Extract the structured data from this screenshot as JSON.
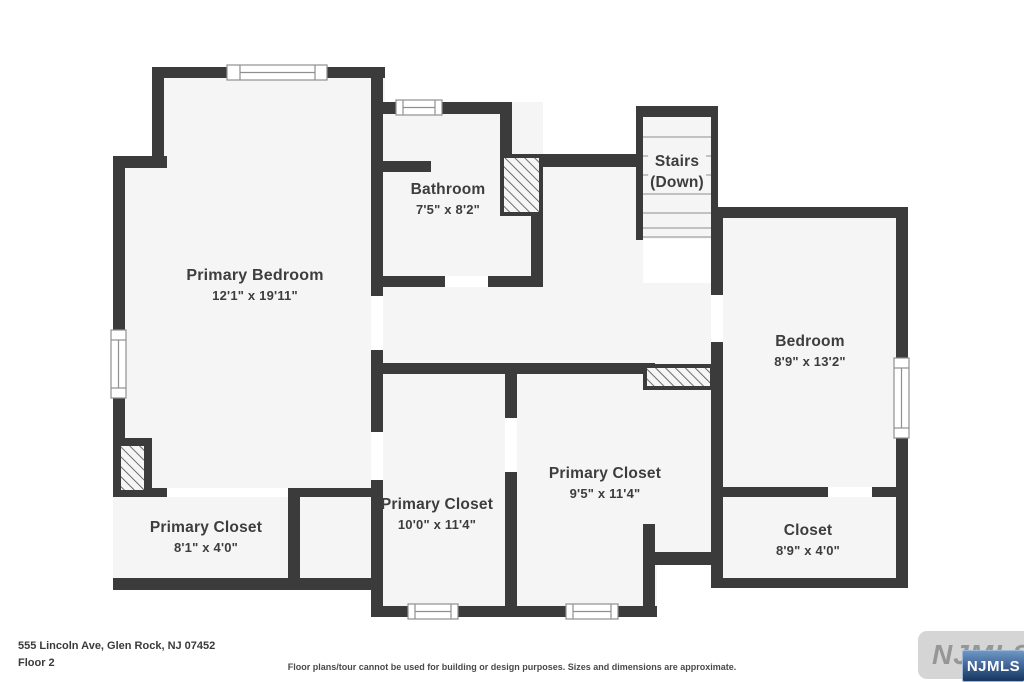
{
  "rooms": {
    "primary_bedroom": {
      "name": "Primary Bedroom",
      "dims": "12'1\" x 19'11\""
    },
    "bathroom": {
      "name": "Bathroom",
      "dims": "7'5\" x 8'2\""
    },
    "stairs": {
      "line1": "Stairs",
      "line2": "(Down)"
    },
    "bedroom": {
      "name": "Bedroom",
      "dims": "8'9\" x 13'2\""
    },
    "primary_closet_a": {
      "name": "Primary Closet",
      "dims": "8'1\" x 4'0\""
    },
    "primary_closet_b": {
      "name": "Primary Closet",
      "dims": "10'0\" x 11'4\""
    },
    "primary_closet_c": {
      "name": "Primary Closet",
      "dims": "9'5\" x 11'4\""
    },
    "closet": {
      "name": "Closet",
      "dims": "8'9\" x 4'0\""
    }
  },
  "footer": {
    "address": "555 Lincoln Ave, Glen Rock, NJ 07452",
    "floor_label": "Floor 2",
    "disclaimer": "Floor plans/tour cannot be used for building or design purposes. Sizes and dimensions are approximate."
  },
  "logo": {
    "watermark_text": "NJMLS",
    "badge_text": "NJMLS"
  },
  "colors": {
    "wall": "#3b3b3b",
    "room_fill": "#f5f5f5",
    "window_line": "#8f8f8f",
    "hatch_line": "#4a4a4a",
    "label_text": "#3d3d3d",
    "badge_blue_top": "#6d97c4",
    "badge_blue_bottom": "#16365f"
  }
}
